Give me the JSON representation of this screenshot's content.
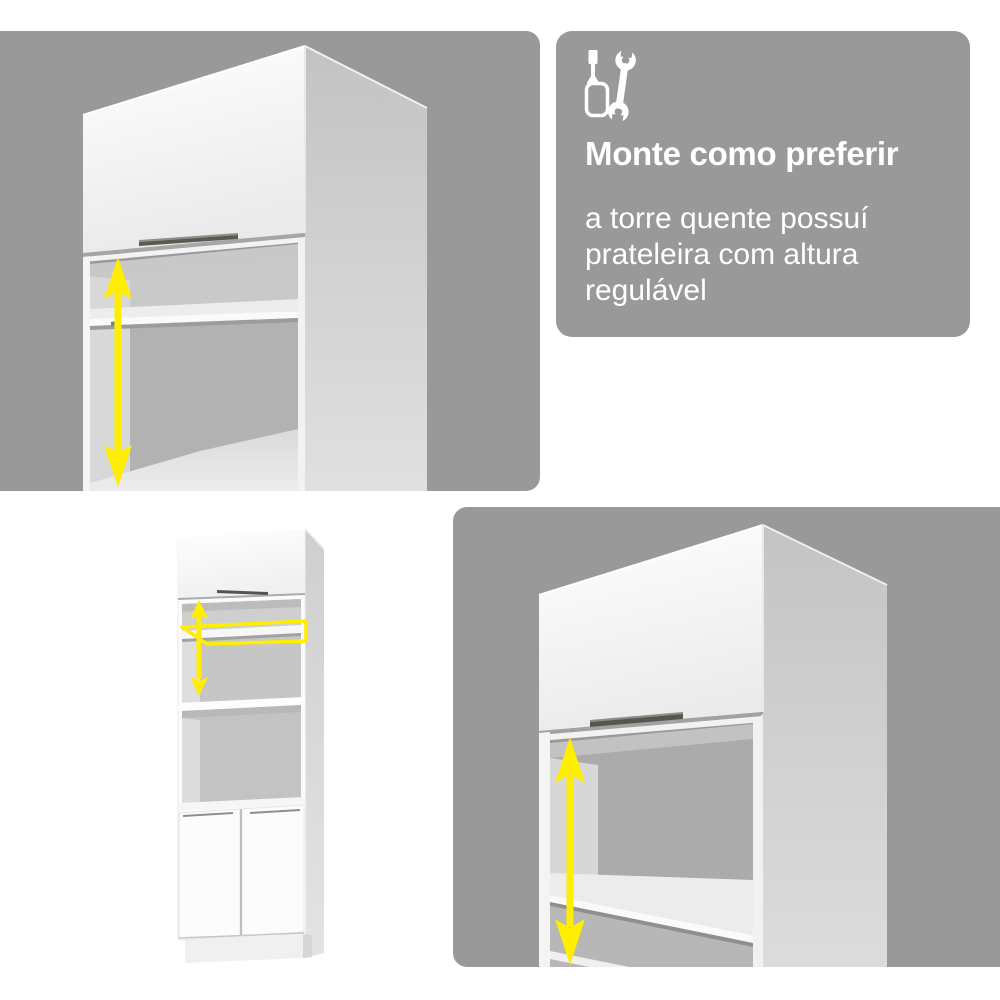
{
  "colors": {
    "page_background": "#ffffff",
    "panel_gray": "#999999",
    "accent_yellow": "#ffee00",
    "text_white": "#ffffff"
  },
  "text_panel": {
    "icon": "screwdriver-wrench-icon",
    "title": "Monte como preferir",
    "body_lines": [
      "a torre quente possuí",
      "prateleira com altura",
      "regulável"
    ]
  },
  "figures": {
    "top_left": "hot-tower-top-closeup",
    "bottom_left": "hot-tower-full-view",
    "bottom_right": "hot-tower-niche-closeup",
    "annotations": {
      "height_arrow": "adjustable-height-arrow",
      "shelf_highlight": "adjustable-shelf-highlight"
    }
  }
}
